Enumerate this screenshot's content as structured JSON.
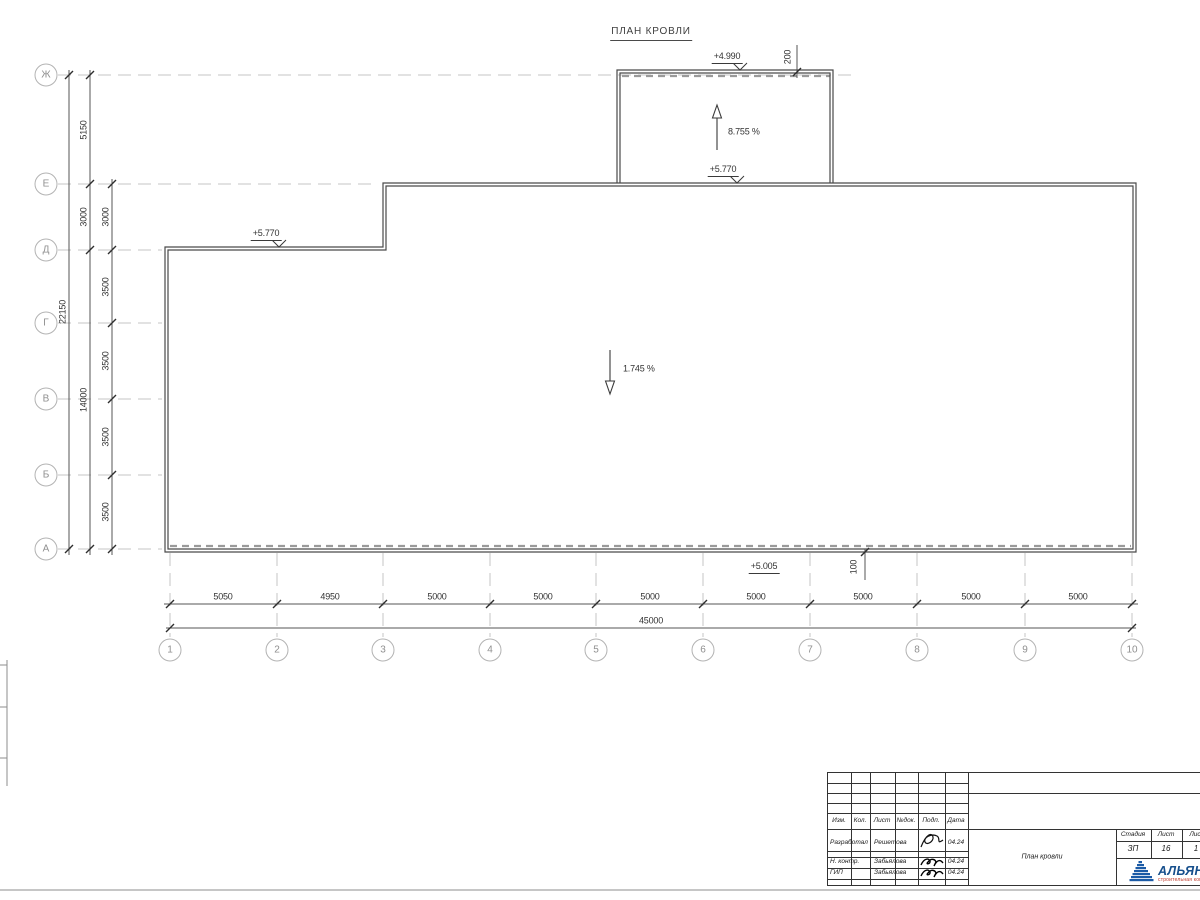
{
  "drawing": {
    "title": "ПЛАН КРОВЛИ"
  },
  "colors": {
    "line_dark": "#4a4a4a",
    "axis_gray": "#c4c4c4",
    "drain_gray": "#9a9a9a",
    "logo_blue": "#1c5ba6",
    "logo_red": "#c0392b"
  },
  "axes": {
    "left": [
      {
        "label": "Ж",
        "y": 75
      },
      {
        "label": "Е",
        "y": 184
      },
      {
        "label": "Д",
        "y": 250
      },
      {
        "label": "Г",
        "y": 323
      },
      {
        "label": "В",
        "y": 399
      },
      {
        "label": "Б",
        "y": 475
      },
      {
        "label": "А",
        "y": 549
      }
    ],
    "bottom": [
      {
        "label": "1",
        "x": 170
      },
      {
        "label": "2",
        "x": 277
      },
      {
        "label": "3",
        "x": 383
      },
      {
        "label": "4",
        "x": 490
      },
      {
        "label": "5",
        "x": 596
      },
      {
        "label": "6",
        "x": 703
      },
      {
        "label": "7",
        "x": 810
      },
      {
        "label": "8",
        "x": 917
      },
      {
        "label": "9",
        "x": 1025
      },
      {
        "label": "10",
        "x": 1132
      }
    ]
  },
  "dimensions": {
    "rotated": [
      {
        "text": "22150",
        "x": 63,
        "y": 312
      },
      {
        "text": "5150",
        "x": 84,
        "y": 130
      },
      {
        "text": "3000",
        "x": 84,
        "y": 217
      },
      {
        "text": "14000",
        "x": 84,
        "y": 400
      },
      {
        "text": "3000",
        "x": 106,
        "y": 217
      },
      {
        "text": "3500",
        "x": 106,
        "y": 287
      },
      {
        "text": "3500",
        "x": 106,
        "y": 361
      },
      {
        "text": "3500",
        "x": 106,
        "y": 437
      },
      {
        "text": "3500",
        "x": 106,
        "y": 512
      },
      {
        "text": "200",
        "x": 788,
        "y": 57
      },
      {
        "text": "100",
        "x": 854,
        "y": 567
      }
    ],
    "bottom_chain": [
      {
        "text": "5050",
        "x": 223,
        "y": 597
      },
      {
        "text": "4950",
        "x": 330,
        "y": 597
      },
      {
        "text": "5000",
        "x": 437,
        "y": 597
      },
      {
        "text": "5000",
        "x": 543,
        "y": 597
      },
      {
        "text": "5000",
        "x": 650,
        "y": 597
      },
      {
        "text": "5000",
        "x": 756,
        "y": 597
      },
      {
        "text": "5000",
        "x": 863,
        "y": 597
      },
      {
        "text": "5000",
        "x": 971,
        "y": 597
      },
      {
        "text": "5000",
        "x": 1078,
        "y": 597
      }
    ],
    "bottom_total": {
      "text": "45000",
      "x": 651,
      "y": 621
    }
  },
  "elevations": [
    {
      "text": "+4.990",
      "x": 727,
      "y": 64
    },
    {
      "text": "+5.770",
      "x": 723,
      "y": 177
    },
    {
      "text": "+5.770",
      "x": 266,
      "y": 241
    },
    {
      "text": "+5.005",
      "x": 764,
      "y": 574
    }
  ],
  "slopes": [
    {
      "text": "8.755 %",
      "x": 728,
      "y": 132
    },
    {
      "text": "1.745 %",
      "x": 623,
      "y": 369
    }
  ],
  "titleblock": {
    "header": {
      "izm": "Изм.",
      "kol": "Кол.",
      "list": "Лист",
      "ndok": "№док.",
      "podp": "Подп.",
      "data": "Дата"
    },
    "rows": [
      {
        "role": "Разработал",
        "name": "Решетова",
        "date": "04.24"
      },
      {
        "role": "Н. контр.",
        "name": "Забьялова",
        "date": "04.24"
      },
      {
        "role": "ГИП",
        "name": "Забьялова",
        "date": "04.24"
      }
    ],
    "doc_name": "План кровли",
    "stage": {
      "h_stage": "Стадия",
      "h_sheet": "Лист",
      "h_sheets": "Лис",
      "v_stage": "ЗП",
      "v_sheet": "16",
      "v_sheets": "1"
    },
    "logo": {
      "name": "АЛЬЯН",
      "subtitle": "строительная комп"
    }
  }
}
